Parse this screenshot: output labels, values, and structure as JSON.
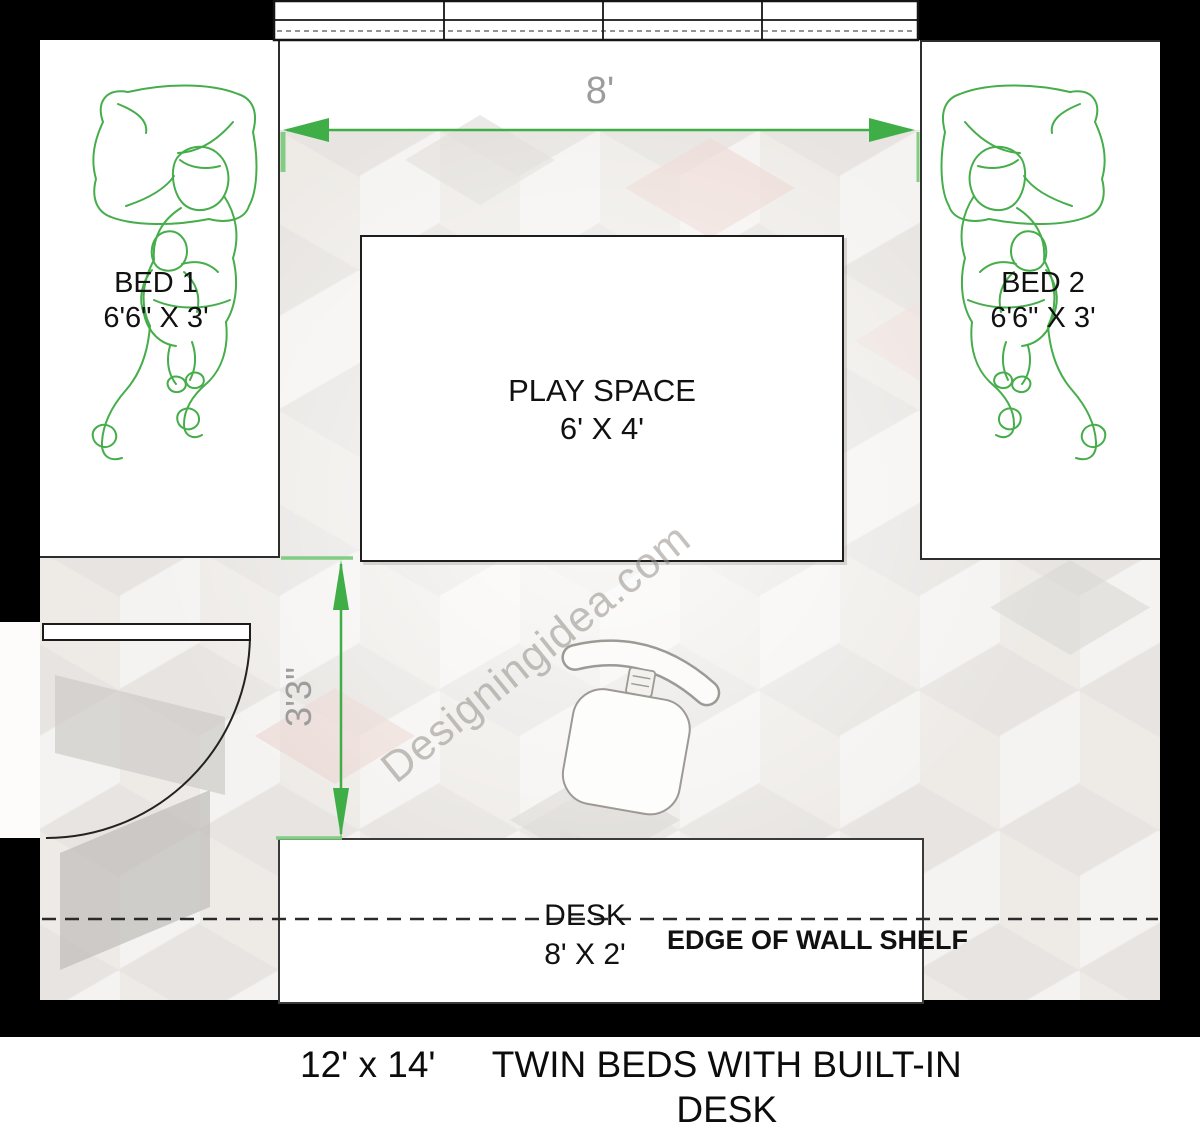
{
  "plan": {
    "bed1": {
      "label": "BED 1",
      "size": "6'6\" X 3'"
    },
    "bed2": {
      "label": "BED 2",
      "size": "6'6\" X 3'"
    },
    "play_space": {
      "label": "PLAY SPACE",
      "size": "6' X 4'"
    },
    "desk": {
      "label": "DESK",
      "size": "8' X 2'"
    },
    "shelf_note": "EDGE OF WALL SHELF",
    "dimensions": {
      "alcove_width": "8'",
      "clearance": "3'3\""
    }
  },
  "watermark": "Designingidea.com",
  "caption": {
    "room_size": "12' x 14'",
    "title": "TWIN BEDS WITH BUILT-IN DESK"
  },
  "colors": {
    "wall": "#000000",
    "dim_green": "#3fae47",
    "green_light": "#82cc84",
    "figure_green": "#46ad4b",
    "label_gray": "#9d9d9d",
    "line_dark": "#2a2a2a",
    "watermark_gray": "#948e88",
    "chair_gray": "#9d9994",
    "pattern_pink": "#ecd9d4",
    "pattern_gray": "#d2cfcc"
  }
}
